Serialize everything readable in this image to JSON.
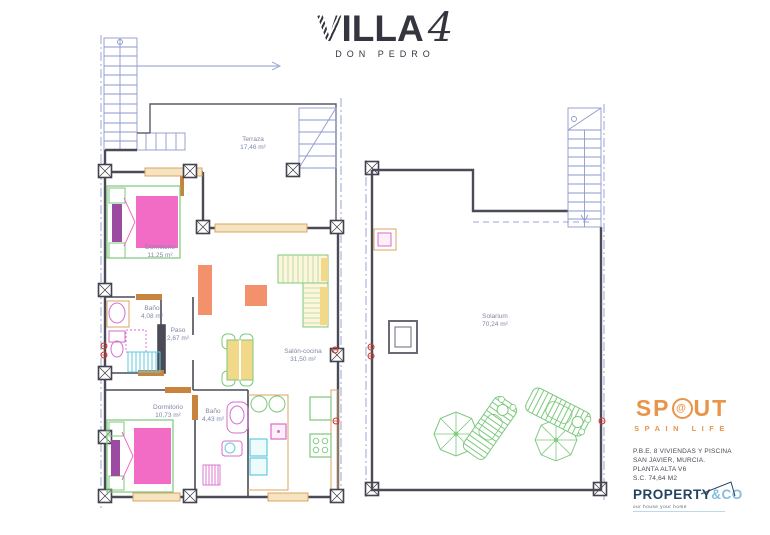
{
  "title": {
    "main": "VILLA",
    "numeral": "4",
    "subtitle": "DON PEDRO"
  },
  "plans": {
    "left": {
      "rooms": [
        {
          "label": "Terraza",
          "area": "17,46 m²"
        },
        {
          "label": "Dormitorio",
          "area": "11,25 m²"
        },
        {
          "label": "Baño",
          "area": "4,08 m²"
        },
        {
          "label": "Paso",
          "area": "2,67 m²"
        },
        {
          "label": "Salón-cocina",
          "area": "31,50 m²"
        },
        {
          "label": "Dormitorio",
          "area": "10,73 m²"
        },
        {
          "label": "Baño",
          "area": "4,43 m²"
        }
      ]
    },
    "right": {
      "rooms": [
        {
          "label": "Solarium",
          "area": "70,24 m²"
        }
      ]
    }
  },
  "branding": {
    "spout": {
      "part1": "SP",
      "symbol": "@",
      "part2": "UT",
      "tagline": "SPAIN LIFE"
    },
    "project_info": {
      "line1": "P.B.E. 8 VIVIENDAS Y PISCINA",
      "line2": "SAN JAVIER, MURCIA.",
      "line3": "PLANTA ALTA V6",
      "line4": "S.C. 74,64 M2"
    },
    "agency": {
      "name": "PROPERTY",
      "suffix": "&CO",
      "tagline": "our house your home"
    }
  },
  "colors": {
    "wall": "#4b4b57",
    "guide_blue": "#9aa5d8",
    "label_text": "#8287a8",
    "plan_pink": "#f26bc4",
    "plan_purple": "#9c4ca0",
    "plan_green": "#7cc87c",
    "plan_yellow": "#f2d98a",
    "plan_coral": "#f2916b",
    "plan_cyan": "#62cbe0",
    "plan_magenta": "#d76ccd",
    "window_tan": "#d9a45f",
    "red_marker": "#cc3b35",
    "brand_orange": "#e8954a",
    "agency_navy": "#25435f",
    "agency_blue": "#85bdde"
  }
}
